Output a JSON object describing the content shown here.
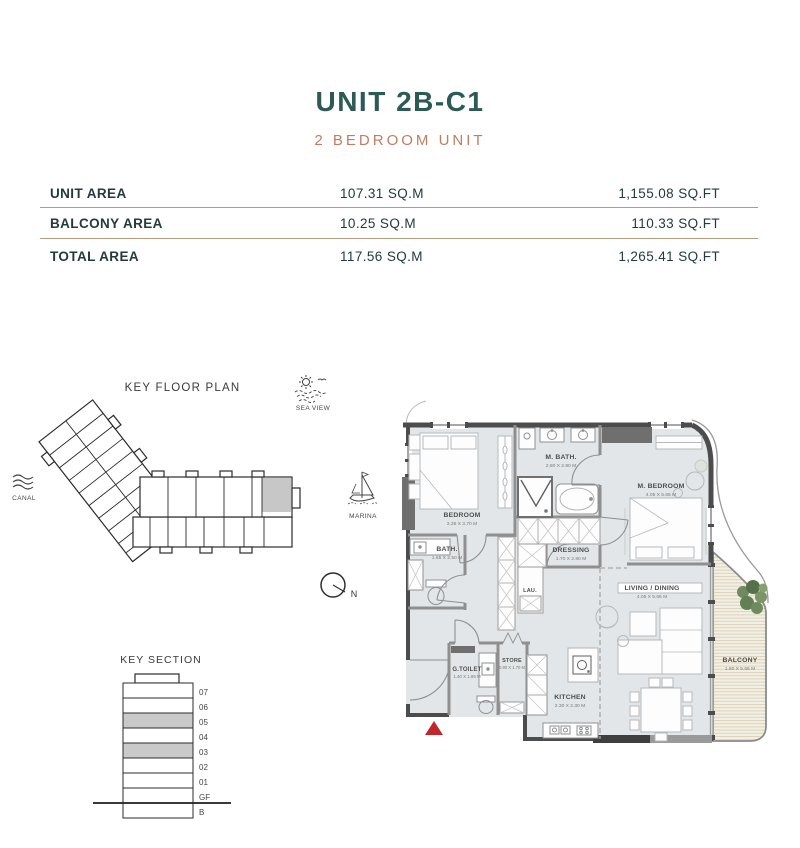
{
  "header": {
    "title": "UNIT 2B-C1",
    "subtitle": "2 BEDROOM UNIT"
  },
  "area_table": {
    "rows": [
      {
        "label": "UNIT AREA",
        "sqm": "107.31 SQ.M",
        "sqft": "1,155.08 SQ.FT"
      },
      {
        "label": "BALCONY AREA",
        "sqm": "10.25 SQ.M",
        "sqft": "110.33 SQ.FT"
      },
      {
        "label": "TOTAL AREA",
        "sqm": "117.56 SQ.M",
        "sqft": "1,265.41 SQ.FT"
      }
    ]
  },
  "key_floor_plan": {
    "title": "KEY FLOOR PLAN",
    "labels": {
      "canal": "CANAL",
      "sea_view": "SEA VIEW",
      "marina": "MARINA",
      "north": "N"
    }
  },
  "key_section": {
    "title": "KEY SECTION",
    "floors": [
      "07",
      "06",
      "05",
      "04",
      "03",
      "02",
      "01",
      "GF",
      "B"
    ],
    "highlighted_floors": [
      "05",
      "03"
    ]
  },
  "floor_plan": {
    "rooms": [
      {
        "name": "BEDROOM",
        "dims": "3.35 X 3.70 M"
      },
      {
        "name": "M. BATH.",
        "dims": "2.80 X 2.80 M"
      },
      {
        "name": "M. BEDROOM",
        "dims": "4.05 X 5.65 M"
      },
      {
        "name": "BATH.",
        "dims": "1.65 X 2.50 M"
      },
      {
        "name": "DRESSING",
        "dims": "1.70 X 2.80 M"
      },
      {
        "name": "LAU."
      },
      {
        "name": "G.TOILET",
        "dims": "1.40 X 1.95 M"
      },
      {
        "name": "STORE",
        "dims": "0.90 X 1.70 M"
      },
      {
        "name": "KITCHEN",
        "dims": "2.30 X 2.30 M"
      },
      {
        "name": "LIVING / DINING",
        "dims": "4.05 X 5.65 M"
      },
      {
        "name": "BALCONY",
        "dims": "1.80 X 5.65 M"
      }
    ]
  },
  "colors": {
    "title_teal": "#2c5a55",
    "subtitle_terracotta": "#bd7e62",
    "table_divider": "#b59a80",
    "floor_fill": "#e2e6e8",
    "balcony_fill": "#f3efe2",
    "wall_dark": "#4c4c4c",
    "section_highlight": "#c9c9c9",
    "entrance_marker_red": "#c1262c",
    "plant_green": "#5d7a4e"
  }
}
